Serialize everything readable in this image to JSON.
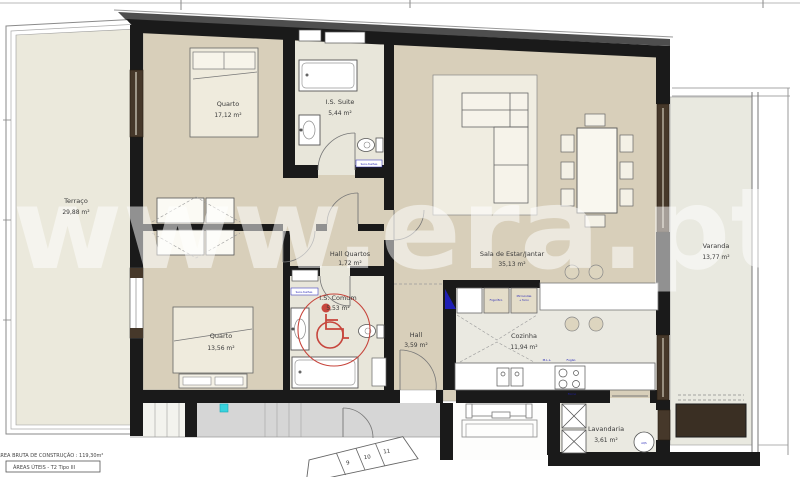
{
  "watermark": "www.era.pt",
  "footer": {
    "gross_area": "ÁREA BRUTA DE CONSTRUÇÃO : 119,30m²",
    "useful_areas": "ÁREAS ÚTEIS - T2 Tipo III"
  },
  "rooms": [
    {
      "name": "Terraço",
      "area": "29,88 m²"
    },
    {
      "name": "Quarto",
      "area": "17,12 m²"
    },
    {
      "name": "I.S. Suite",
      "area": "5,44 m²"
    },
    {
      "name": "Hall Quartos",
      "area": "1,72 m²"
    },
    {
      "name": "Sala de Estar/Jantar",
      "area": "35,13 m²"
    },
    {
      "name": "Varanda",
      "area": "13,77 m²"
    },
    {
      "name": "Quarto",
      "area": "13,56 m²"
    },
    {
      "name": "I.S. Comum",
      "area": "5,53 m²"
    },
    {
      "name": "Hall",
      "area": "3,59 m²"
    },
    {
      "name": "Cozinha",
      "area": "11,94 m²"
    },
    {
      "name": "Lavandaria",
      "area": "3,61 m²"
    }
  ],
  "labels": {
    "fridge": "Frigorífico",
    "microwave_line1": "Microondas",
    "microwave_line2": "+ forno",
    "dishwasher": "M.L.L.",
    "stove": "Fogão",
    "oven": "Forno",
    "towel_dryer_suite": "Seca-toalhas",
    "towel_dryer_common": "Seca-toalhas",
    "water_heater": "AQS"
  },
  "stairs": {
    "steps": [
      "9",
      "10",
      "11"
    ]
  },
  "colors": {
    "wall": "#1a1a1a",
    "floor_main": "#d8cfba",
    "floor_light": "#e8e6da",
    "terrace": "#ebe9dc",
    "corridor": "#d6d6d6",
    "accent_red": "#c7463d",
    "accent_blue": "#1f1fb4",
    "cyan_marker": "#38d3de",
    "wood": "#46382a"
  }
}
